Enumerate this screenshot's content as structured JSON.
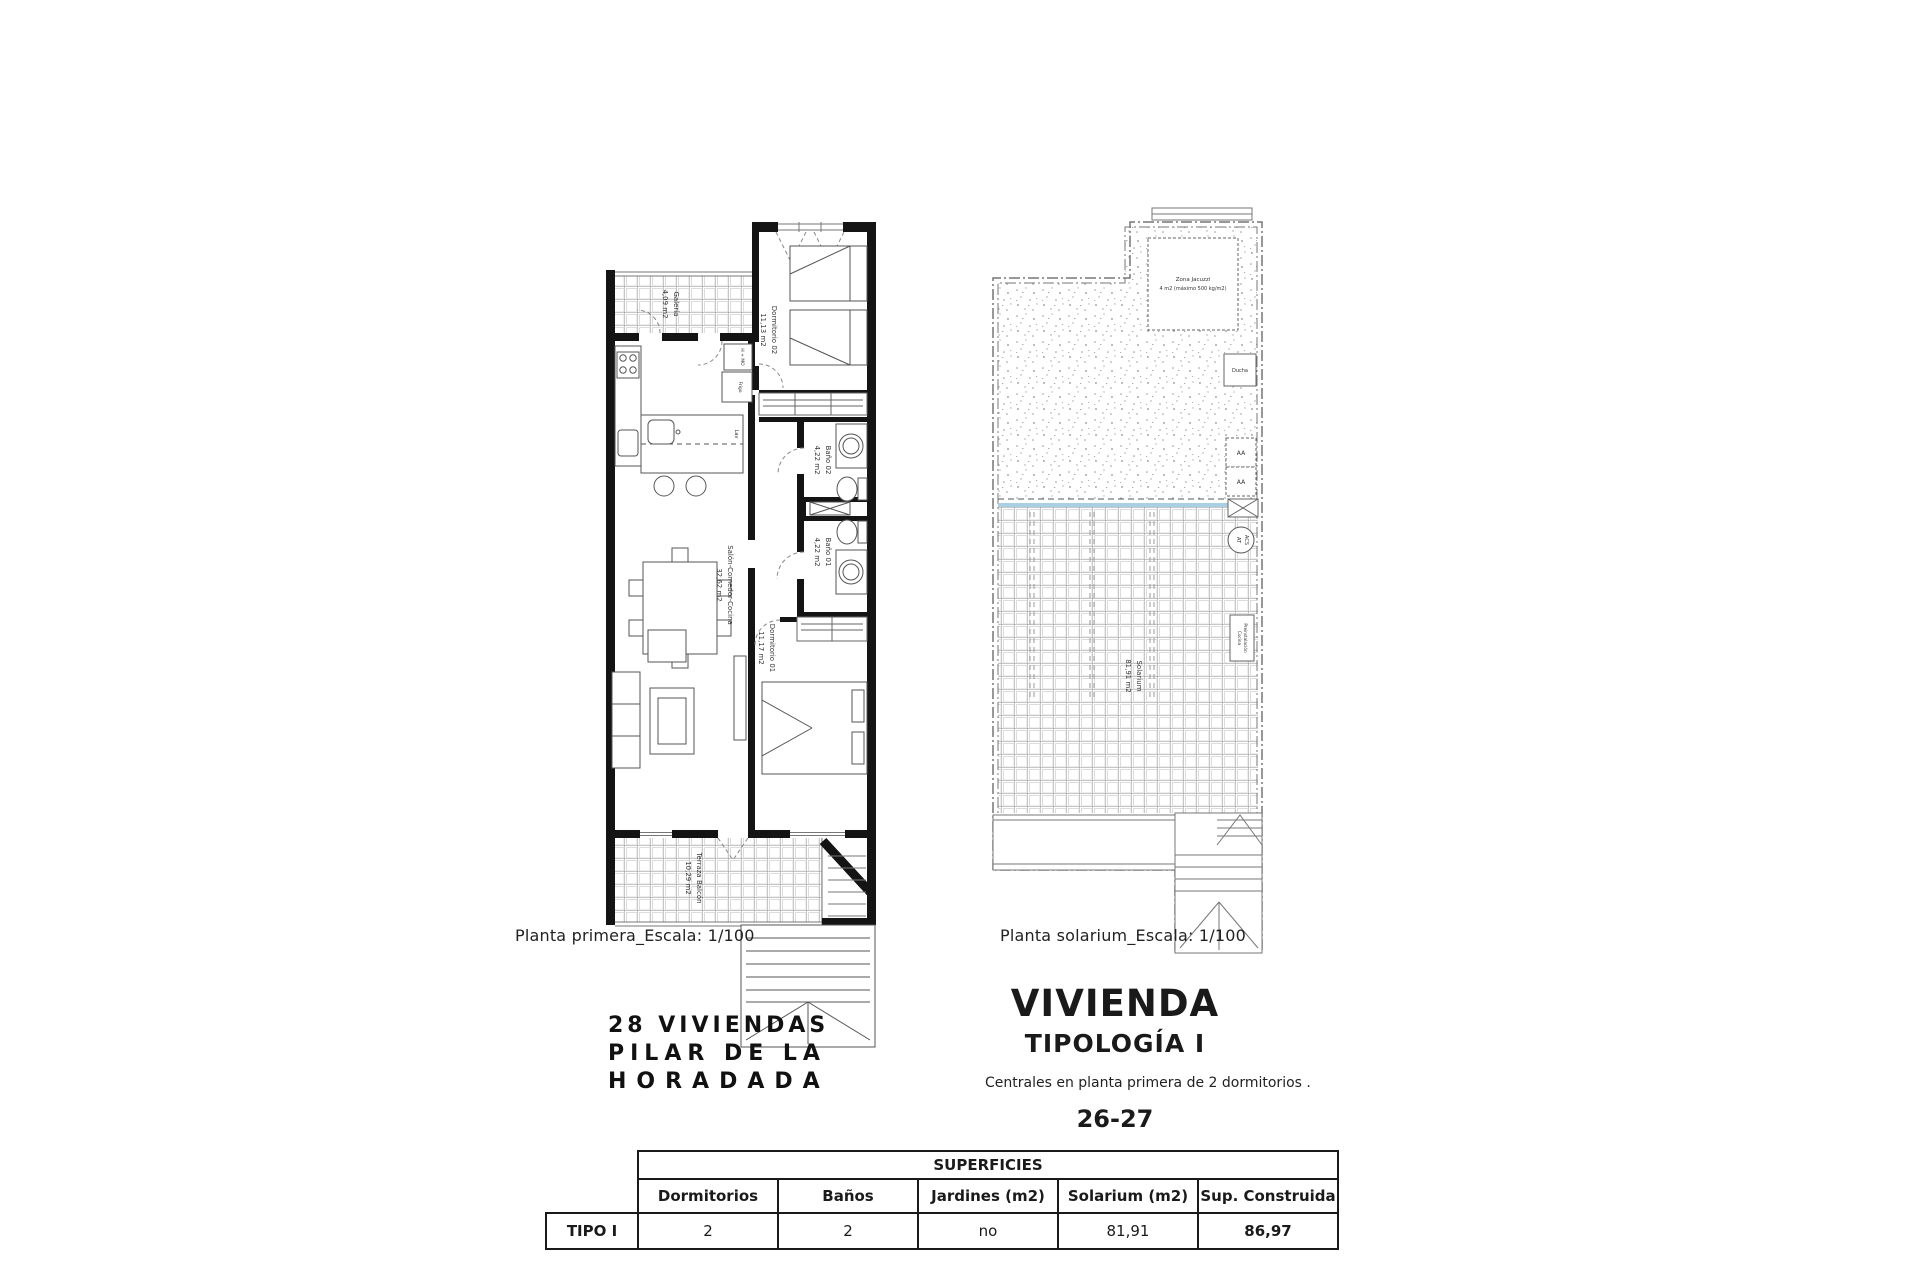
{
  "titles": {
    "project_lines": [
      "28 VIVIENDAS",
      "PILAR DE LA",
      "HORADADA"
    ],
    "vivienda": "VIVIENDA",
    "tipologia": "TIPOLOGÍA I",
    "subtitle": "Centrales en planta primera de 2 dormitorios .",
    "units": "26-27"
  },
  "plan_primera": {
    "caption": "Planta primera_Escala: 1/100",
    "rooms": {
      "galeria": {
        "name": "Galería",
        "area": "4,09 m2"
      },
      "dorm02": {
        "name": "Dormitorio 02",
        "area": "11,13 m2"
      },
      "bano02": {
        "name": "Baño 02",
        "area": "4,22 m2"
      },
      "bano01": {
        "name": "Baño 01",
        "area": "4,22 m2"
      },
      "salon": {
        "name": "Salón-Comedor-Cocina",
        "area": "32,62 m2"
      },
      "dorm01": {
        "name": "Dormitorio 01",
        "area": "11,17 m2"
      },
      "terraza": {
        "name": "Terraza Balcón",
        "area": "10,29 m2"
      }
    },
    "labels": {
      "horno": "H + MO",
      "frigo": "Frigo",
      "lav": "Lav"
    }
  },
  "plan_solarium": {
    "caption": "Planta solarium_Escala: 1/100",
    "room": {
      "name": "Solarium",
      "area": "81,91 m2"
    },
    "labels": {
      "jacuzzi_line1": "Zona Jacuzzi",
      "jacuzzi_line2": "4 m2 (máximo 500 kg/m2)",
      "ducha": "Ducha",
      "aa": "AA",
      "acs_line1": "ACS",
      "acs_line2": "AT",
      "preinst_line1": "Preinstalación",
      "preinst_line2": "Cocina"
    },
    "colors": {
      "pool_edge": "#a8cfe3"
    }
  },
  "table": {
    "title": "SUPERFICIES",
    "row_label": "TIPO I",
    "columns": [
      "Dormitorios",
      "Baños",
      "Jardines (m2)",
      "Solarium (m2)",
      "Sup. Construida"
    ],
    "values": [
      "2",
      "2",
      "no",
      "81,91",
      "86,97"
    ]
  }
}
